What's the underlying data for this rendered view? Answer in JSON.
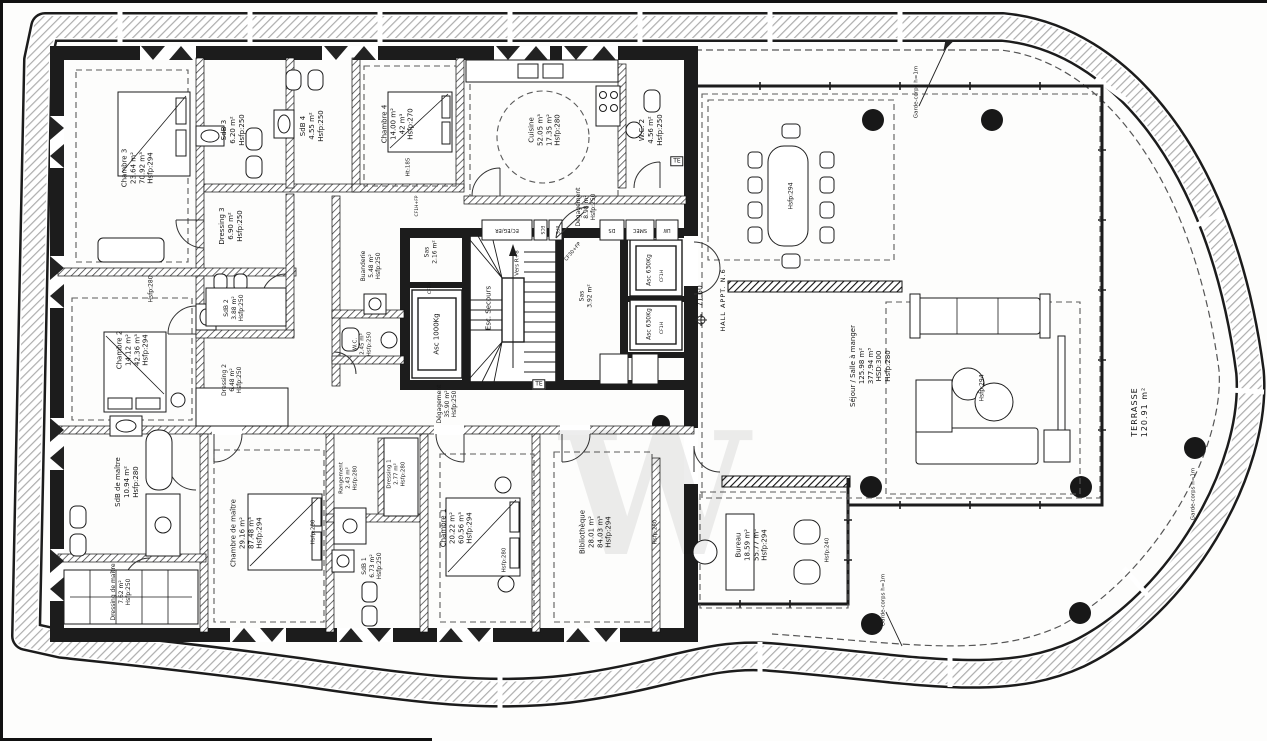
{
  "colors": {
    "ink": "#1a1a1a",
    "band_hatch": "#adadad",
    "partition_hatch": "#3c3c3c",
    "dashed_zone": "#5a5a5a",
    "paper": "#fdfdfc"
  },
  "watermark": "W",
  "rooms": [
    {
      "id": "chambre-3",
      "lines": [
        "Chambre 3",
        "23.64 m²",
        "70.92 m³",
        "Hsfp:294"
      ]
    },
    {
      "id": "sdb-3",
      "lines": [
        "SdB 3",
        "6.20 m²",
        "Hsfp:250"
      ]
    },
    {
      "id": "sdb-4",
      "lines": [
        "SdB 4",
        "4.55 m²",
        "Hsfp:250"
      ]
    },
    {
      "id": "chambre-4",
      "lines": [
        "Chambre 4",
        "14.00 m²",
        "42 m³",
        "Hsfp:270"
      ]
    },
    {
      "id": "cuisine",
      "lines": [
        "Cuisine",
        "52.05 m³",
        "17.35 m²",
        "Hsfp:280"
      ]
    },
    {
      "id": "wc-2",
      "lines": [
        "W.C. 2",
        "4.56 m²",
        "Hsfp:250"
      ]
    },
    {
      "id": "degagement-entree",
      "lines": [
        "Dégagement",
        "8.98 m²",
        "Hsfp:250"
      ]
    },
    {
      "id": "dressing-3",
      "lines": [
        "Dressing 3",
        "6.90 m²",
        "Hsfp:250"
      ]
    },
    {
      "id": "sdb-2",
      "lines": [
        "SdB 2",
        "3.88 m²",
        "Hsfp:250"
      ]
    },
    {
      "id": "dressing-2",
      "lines": [
        "Dressing 2",
        "6.48 m²",
        "Hsfp:250"
      ]
    },
    {
      "id": "chambre-2",
      "lines": [
        "Chambre 2",
        "14.12 m²",
        "42.36 m³",
        "Hsfp:294"
      ]
    },
    {
      "id": "buanderie",
      "lines": [
        "Buanderie",
        "5.48 m²",
        "Hsfp:250"
      ]
    },
    {
      "id": "wc-1",
      "lines": [
        "W.C.",
        "2.45 m²",
        "Hsfp:250"
      ]
    },
    {
      "id": "sas-1",
      "lines": [
        "Sas",
        "2.16 m²"
      ]
    },
    {
      "id": "ascenseur-1000",
      "lines": [
        "Asc 1000Kg"
      ]
    },
    {
      "id": "escalier-secours",
      "lines": [
        "Esc. Secours"
      ]
    },
    {
      "id": "sas-2",
      "lines": [
        "Sas",
        "3.92 m²"
      ]
    },
    {
      "id": "ascenseur-630-a",
      "lines": [
        "Asc 630Kg"
      ]
    },
    {
      "id": "ascenseur-630-b",
      "lines": [
        "Asc 630Kg"
      ]
    },
    {
      "id": "degagement-nuit",
      "lines": [
        "Dégagement",
        "35.90 m²",
        "Hsfp:250"
      ]
    },
    {
      "id": "rangement",
      "lines": [
        "Rangement",
        "2.43 m²",
        "Hsfp:280"
      ]
    },
    {
      "id": "dressing-1",
      "lines": [
        "Dressing 1",
        "2.77 m²",
        "Hsfp:280"
      ]
    },
    {
      "id": "sdb-1",
      "lines": [
        "SdB 1",
        "6.73 m²",
        "Hsfp:250"
      ]
    },
    {
      "id": "chambre-1",
      "lines": [
        "Chambre 1",
        "20.22 m²",
        "60.56 m³",
        "Hsfp:294"
      ]
    },
    {
      "id": "bibliotheque",
      "lines": [
        "Bibliothèque",
        "28.01 m²",
        "84.03 m³",
        "Hsfp:294"
      ]
    },
    {
      "id": "chambre-maitre",
      "lines": [
        "Chambre de maître",
        "29.16 m²",
        "87.48 m³",
        "Hsfp:294"
      ]
    },
    {
      "id": "sdb-maitre",
      "lines": [
        "SdB de maître",
        "10.94 m²",
        "Hsfp:280"
      ]
    },
    {
      "id": "dressing-maitre",
      "lines": [
        "Dressing de maître",
        "7.62 m²",
        "Hsfp:250"
      ]
    },
    {
      "id": "bureau",
      "lines": [
        "Bureau",
        "18.59 m²",
        "55.77 m³",
        "Hsfp:294"
      ]
    },
    {
      "id": "sejour",
      "lines": [
        "Séjour / Salle à manger",
        "125.98 m²",
        "377.94 m³",
        "HSD:300",
        "Hsfp:280"
      ]
    },
    {
      "id": "terrasse",
      "lines": [
        "TERRASSE",
        "120.91 m²"
      ]
    },
    {
      "id": "hall",
      "lines": [
        "HALL APPT. N.6"
      ]
    }
  ],
  "technical": {
    "hsfp294": "Hsfp:294",
    "hsfp280": "Hsfp:280",
    "hsfp240": "Hsfp:240",
    "level": "71.60",
    "garde_corps": "Garde-corps h=1m",
    "ht185": "Ht:185",
    "te": "TE",
    "ds": "DS",
    "smec": "SMEC",
    "lw": "LW",
    "ec_eg_er": "EC/EG/ER",
    "ecs": "ECS",
    "efs": "EFS",
    "cf30": "CF30+FP",
    "cf1hfp": "CF1H+FP",
    "cf2h": "CF2H",
    "cf1h": "CF1H",
    "vers": "Vers R+8"
  }
}
